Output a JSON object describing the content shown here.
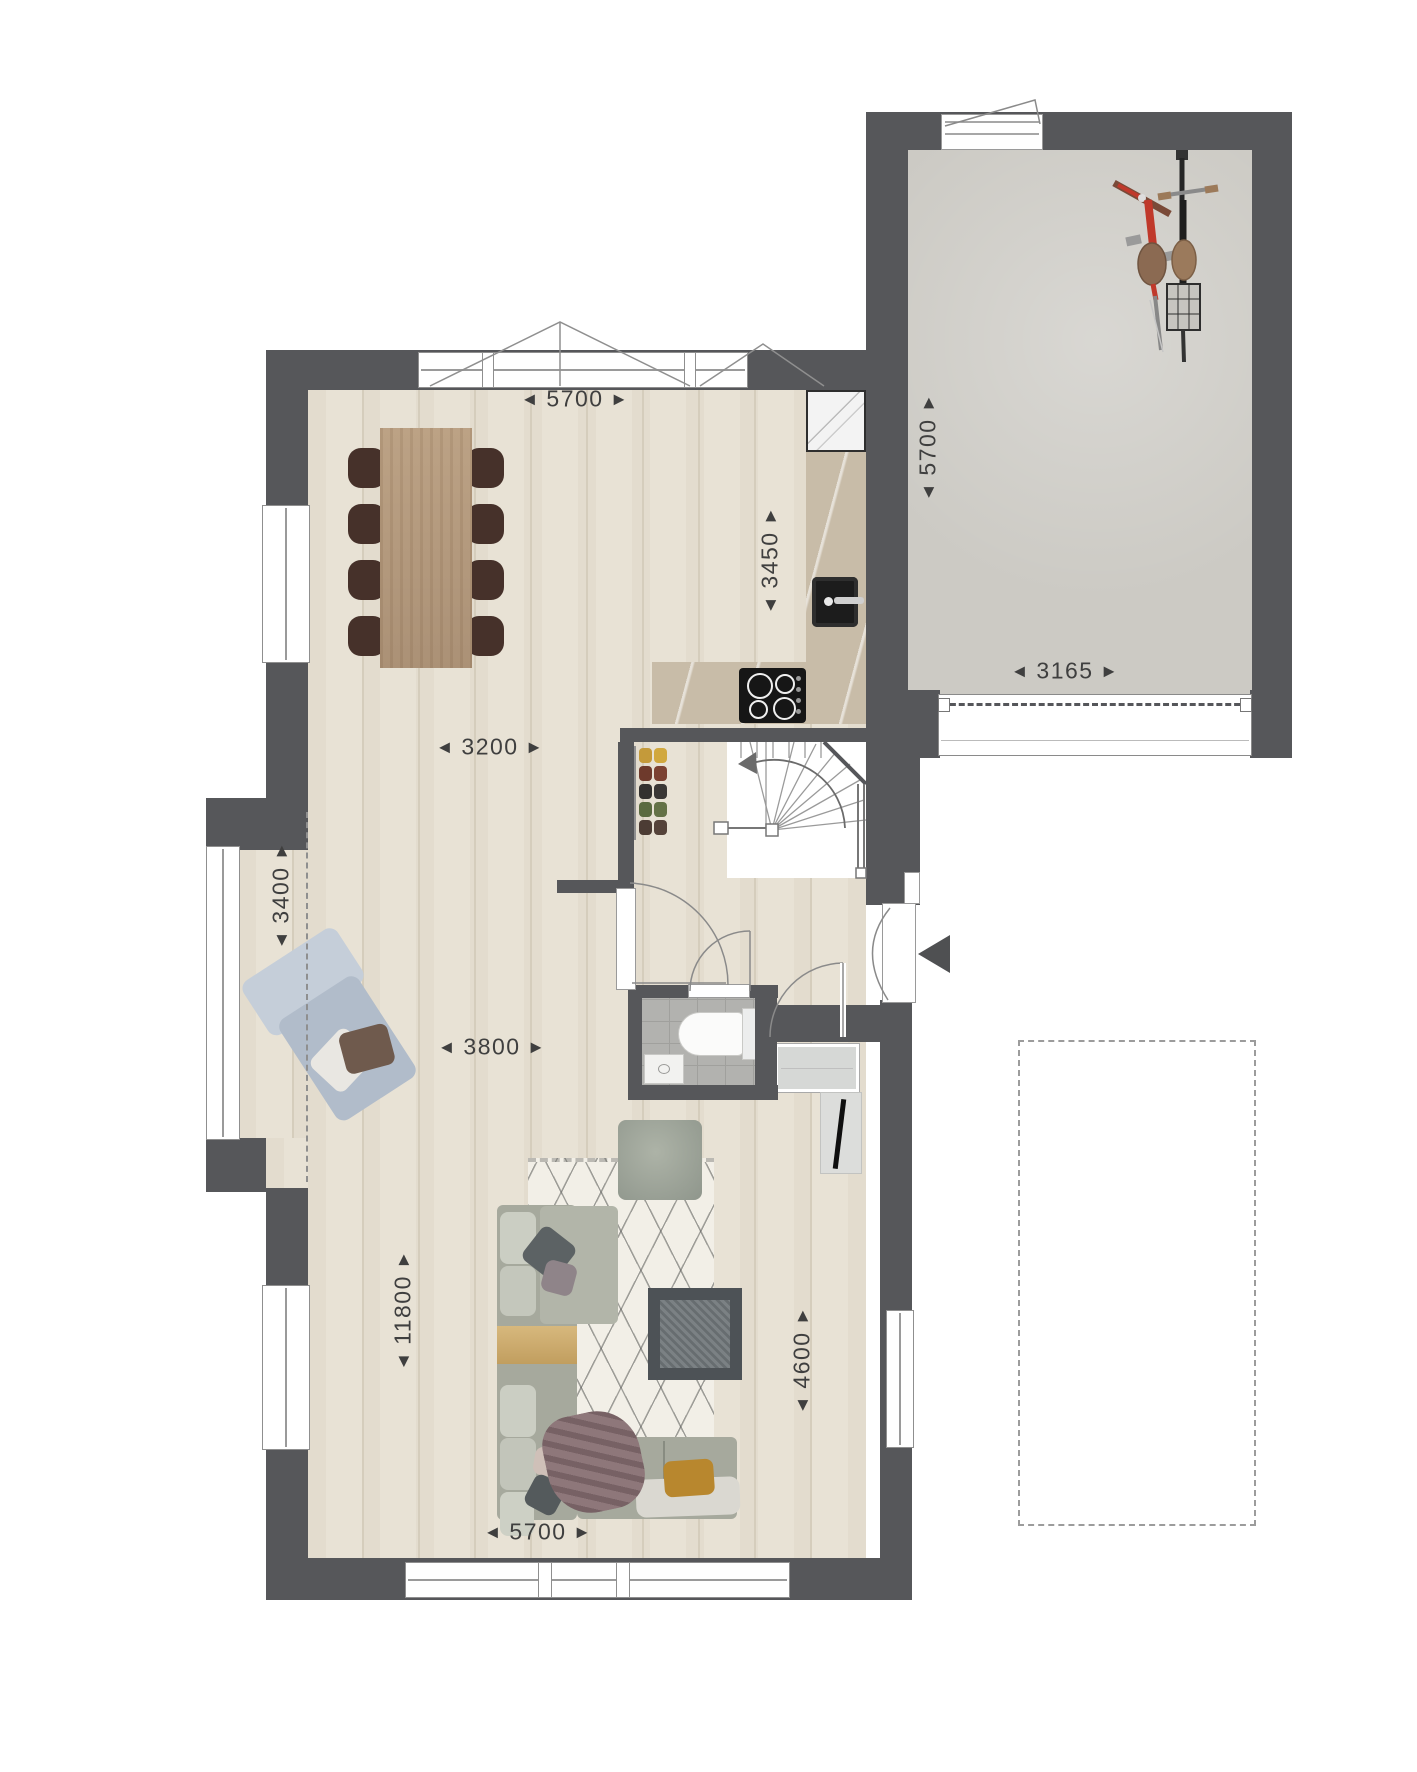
{
  "arrows": {
    "left": "◀",
    "right": "▶"
  },
  "dimensions": [
    {
      "value": "5700",
      "orientation": "horizontal",
      "location": "top-room-width"
    },
    {
      "value": "5700",
      "orientation": "vertical",
      "location": "garage-depth"
    },
    {
      "value": "3450",
      "orientation": "vertical",
      "location": "kitchen-depth"
    },
    {
      "value": "3165",
      "orientation": "horizontal",
      "location": "garage-width"
    },
    {
      "value": "3200",
      "orientation": "horizontal",
      "location": "dining-width"
    },
    {
      "value": "3400",
      "orientation": "vertical",
      "location": "bay-height"
    },
    {
      "value": "3800",
      "orientation": "horizontal",
      "location": "living-width"
    },
    {
      "value": "11800",
      "orientation": "vertical",
      "location": "house-depth"
    },
    {
      "value": "4600",
      "orientation": "vertical",
      "location": "living-depth"
    },
    {
      "value": "5700",
      "orientation": "horizontal",
      "location": "bottom-room-width"
    }
  ],
  "colors": {
    "wall": "#56575a",
    "wood_floor": "#e8e2d5",
    "plank_line": "#d9d2c2",
    "garage_floor": "#cccac4",
    "kitchen_counter": "#c8bca8",
    "bathroom_tile": "#b2b2af",
    "rug": "#f2efe7",
    "sofa": "#a6a99d",
    "gold_table": "#c8a76b",
    "lounge_chair": "#b1bcca",
    "dining_table": "#b59c80",
    "dining_chair": "#46312a",
    "bike_red": "#c0392b",
    "dimension_text": "#3f3f3f"
  }
}
